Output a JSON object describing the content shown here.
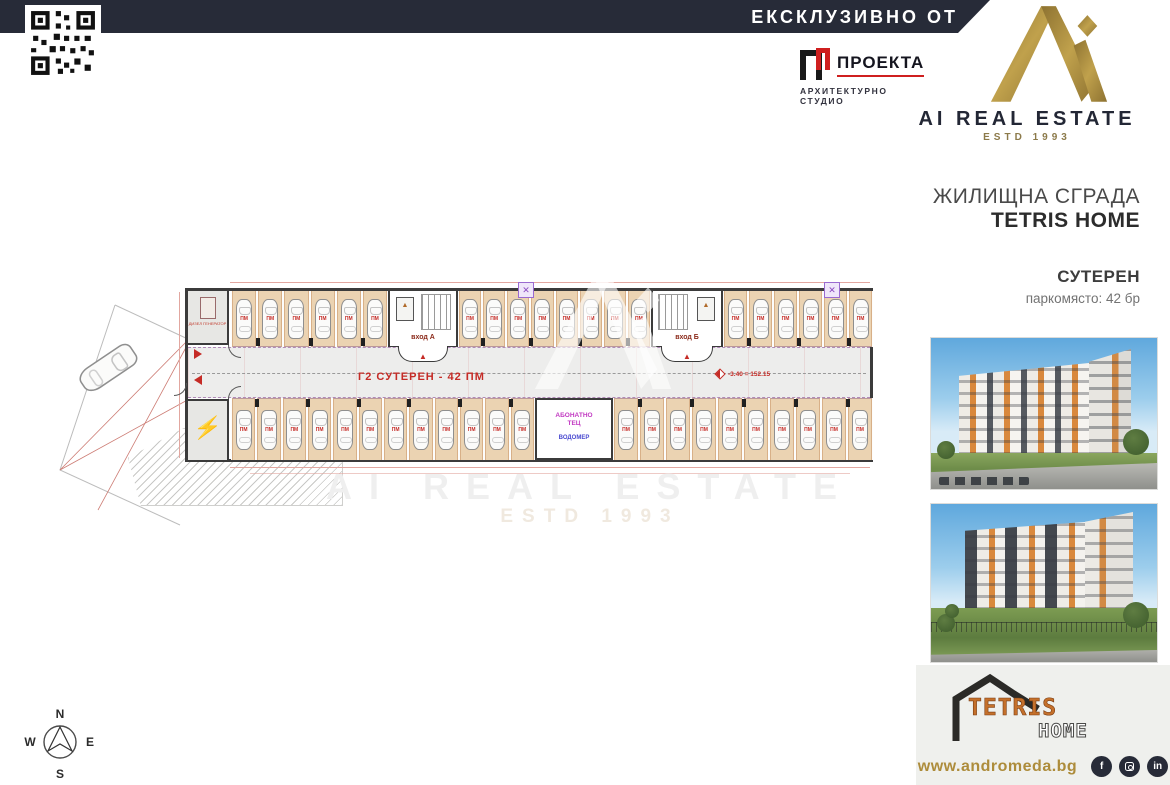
{
  "banner": {
    "exclusive": "ЕКСКЛУЗИВНО ОТ"
  },
  "brand": {
    "name": "AI REAL ESTATE",
    "estd": "ESTD 1993"
  },
  "architect": {
    "name": "ПРОЕКТА",
    "subtitle": "АРХИТЕКТУРНО СТУДИО"
  },
  "project": {
    "type": "ЖИЛИЩНА СГРАДА",
    "name": "TETRIS HOME",
    "level": "СУТЕРЕН",
    "parking": "паркомясто: 42 бр"
  },
  "plan": {
    "title": "Г2 СУТЕРЕН - 42 ПМ",
    "elevation": "-3.40 = 152.15",
    "entrance_a": "вход А",
    "entrance_b": "вход Б",
    "room_heat": "АБОНАТНО\nТЕЦ",
    "room_water": "ВОДОМЕР",
    "room_generator": "ДИЗЕЛ ГЕНЕРАТОР",
    "bay_label": "ПМ",
    "top_sections": [
      6,
      8,
      6
    ],
    "bottom_sections": [
      12,
      10
    ],
    "total_spaces": 42
  },
  "watermark": {
    "line1": "AI REAL ESTATE",
    "line2": "ESTD 1993"
  },
  "compass": {
    "n": "N",
    "e": "E",
    "s": "S",
    "w": "W"
  },
  "footer": {
    "logo_text": "TETRIS",
    "logo_home": "HOME",
    "website": "www.andromeda.bg",
    "facebook_glyph": "f",
    "linkedin_glyph": "in",
    "social": [
      "facebook",
      "instagram",
      "linkedin"
    ]
  },
  "colors": {
    "navy": "#272b38",
    "gold": "#a08a42",
    "accent_red": "#c52b26",
    "bay_tan": "#ebd3b2"
  }
}
